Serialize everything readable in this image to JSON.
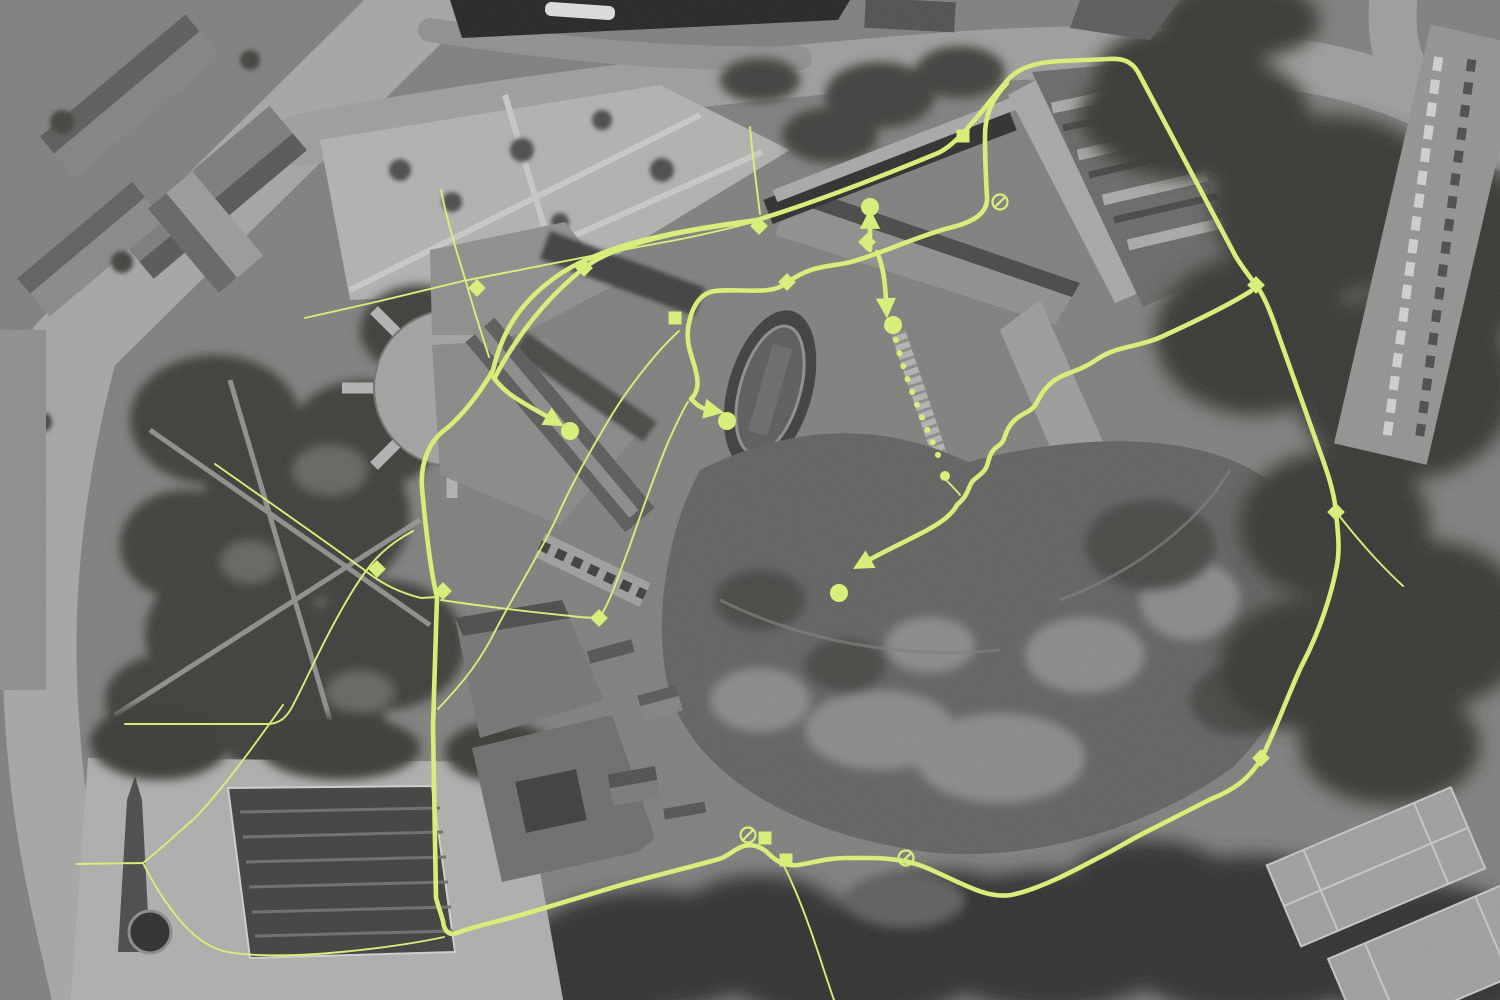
{
  "map": {
    "description": "Grayscale aerial photograph of a hilltop fortress and surrounding city with a lime route overlay",
    "canvas": {
      "width": 1500,
      "height": 1000
    },
    "palette": {
      "overlay_lime": "#d8ee7b",
      "base_gray": "#7e7e7c",
      "road_gray": "#a5a5a3",
      "tree_dark": "#343432",
      "plaza_light": "#aeaeac",
      "river_dark": "#222220"
    }
  },
  "overlay": {
    "color": "#d8ee7b",
    "thick_width": 4.6,
    "thin_width": 1.9,
    "dot_radius": 9,
    "small_dot_radius": 5,
    "diamond_size": 12.5,
    "square_size": 13,
    "no_entry_radius": 7.5,
    "dotted_dot_size": 6,
    "routes_thick": [
      {
        "name": "main-loop-route",
        "d": "M 493,370 C 502,332 520,300 563,272 C 610,243 680,230 757,220 C 812,203 880,177 938,153 C 960,143 984,107 1006,82 C 1015,70 1032,62 1062,61 L 1108,59 C 1124,58 1132,62 1138,72 L 1236,257 C 1243,268 1249,276 1256,285 C 1263,294 1270,310 1277,331 L 1319,449 C 1327,471 1334,491 1336,512 C 1338,533 1340,548 1337,565 C 1332,592 1321,629 1301,667 C 1288,695 1276,729 1262,757 C 1251,777 1236,789 1211,799 L 1152,829 C 1131,839 1113,851 1098,858 C 1079,868 1041,889 1011,895 C 986,899 962,883 927,868 C 911,861 891,858 869,858 L 846,858 C 826,858 813,863 798,865 C 786,866 778,863 769,854 C 761,846 751,843 741,847 C 732,851 727,857 719,859 C 691,867 661,874 621,885 L 521,915 C 496,922 471,927 457,933 C 449,936 444,931 443,921 L 436,898 L 433,727 L 437,597 C 434,585 428,554 422,488 C 420,462 430,440 446,429 C 464,414 482,390 493,370 Z"
      },
      {
        "name": "glacis-parallel-route",
        "d": "M 495,377 C 520,330 550,295 584,268 C 620,240 700,228 755,221"
      },
      {
        "name": "barracks-return-route",
        "d": "M 1007,83 C 994,97 985,112 985,136 C 985,161 986,180 987,197 C 988,213 974,222 949,228 C 918,236 880,254 851,262 C 830,267 810,265 787,283 C 770,296 741,288 715,291 C 700,293 691,307 688,329 C 686,348 694,359 697,377 C 699,389 695,395 691,399"
      },
      {
        "name": "serpentine-descent-route",
        "d": "M 1251,291 C 1229,305 1196,321 1161,337 C 1136,348 1118,345 1096,360 C 1076,374 1061,372 1048,386 C 1036,398 1039,406 1027,412 C 1015,418 1009,424 1005,436 C 1001,448 997,444 992,452 C 987,460 989,466 983,472 C 975,480 973,478 969,488 C 965,498 962,500 957,505"
      }
    ],
    "routes_thin": [
      {
        "name": "park-diagonal-path",
        "d": "M 305,318 L 380,301 L 463,281 C 530,268 610,252 660,243 C 700,236 731,228 754,222"
      },
      {
        "name": "plaza-north-path",
        "d": "M 441,190 C 448,225 458,256 466,282 C 472,304 481,332 489,357"
      },
      {
        "name": "north-gate-path",
        "d": "M 750,127 C 753,160 757,190 760,214"
      },
      {
        "name": "moat-diagonal-path",
        "d": "M 679,331 C 656,352 626,390 607,423 C 586,458 569,490 557,517 C 541,552 516,590 491,639 C 474,671 452,694 438,709"
      },
      {
        "name": "moat-lower-path",
        "d": "M 441,600 C 481,606 531,612 571,616 C 586,618 595,618 600,617 C 611,600 619,574 629,548 C 641,514 656,470 669,440 C 676,425 682,411 688,402"
      },
      {
        "name": "west-park-path",
        "d": "M 125,724 L 267,724 C 280,724 286,717 291,709 C 303,687 316,657 331,629 C 346,601 356,584 369,567 C 381,551 398,539 413,531"
      },
      {
        "name": "west-cross-path",
        "d": "M 215,464 C 266,500 321,538 363,569 C 383,585 401,593 421,598 L 437,597"
      },
      {
        "name": "southwest-link-path",
        "d": "M 77,864 L 143,863 C 161,849 176,834 194,819 C 223,789 253,747 283,705"
      },
      {
        "name": "plaza-south-path",
        "d": "M 143,863 C 152,881 166,905 184,925 C 197,939 211,949 228,952 C 256,957 301,956 341,952 C 372,949 412,944 444,937"
      },
      {
        "name": "south-exit-path",
        "d": "M 784,866 C 794,886 806,916 816,946 C 823,967 829,986 834,1000"
      },
      {
        "name": "east-exit-path",
        "d": "M 1337,513 C 1356,537 1376,561 1403,586"
      },
      {
        "name": "gate-link-path",
        "d": "M 947,481 C 952,486 957,491 960,495"
      }
    ],
    "arrows": [
      {
        "name": "arrow-to-north-gate-dot",
        "d": "M 870,250 L 870,227"
      },
      {
        "name": "arrow-to-courtyard-dot",
        "d": "M 877,252 C 883,266 885,281 886,300"
      },
      {
        "name": "arrow-to-terrace-dot",
        "d": "M 691,399 C 697,405 701,408 706,409"
      },
      {
        "name": "arrow-to-plaza-dot",
        "d": "M 492,375 C 504,394 522,402 548,417"
      },
      {
        "name": "arrow-to-hilltop-dot",
        "d": "M 957,505 C 946,526 908,538 869,560"
      }
    ],
    "dotted_path": {
      "name": "stairs-dotted-path",
      "d": "M 896,340 C 906,382 925,425 941,462",
      "dot_gap": 13.5
    },
    "dots": [
      {
        "name": "waypoint-dot-north-gate",
        "x": 870,
        "y": 207
      },
      {
        "name": "waypoint-dot-courtyard",
        "x": 893,
        "y": 325
      },
      {
        "name": "waypoint-dot-terrace",
        "x": 727,
        "y": 421
      },
      {
        "name": "waypoint-dot-west-plaza",
        "x": 570,
        "y": 431
      },
      {
        "name": "waypoint-dot-hilltop",
        "x": 839,
        "y": 593
      },
      {
        "name": "waypoint-dot-gate-small",
        "x": 945,
        "y": 476,
        "small": true
      }
    ],
    "diamonds": [
      {
        "name": "node-park-west",
        "x": 477,
        "y": 288
      },
      {
        "name": "node-glacis",
        "x": 584,
        "y": 268
      },
      {
        "name": "node-north-junction",
        "x": 759,
        "y": 226
      },
      {
        "name": "node-north-terrace",
        "x": 787,
        "y": 282
      },
      {
        "name": "node-north-gate",
        "x": 867,
        "y": 242
      },
      {
        "name": "node-west-junction",
        "x": 443,
        "y": 591
      },
      {
        "name": "node-moat-south",
        "x": 599,
        "y": 618
      },
      {
        "name": "node-southwest-cross",
        "x": 377,
        "y": 569
      },
      {
        "name": "node-northeast-corner",
        "x": 1256,
        "y": 285
      },
      {
        "name": "node-east-slope",
        "x": 1336,
        "y": 512
      },
      {
        "name": "node-southeast-slope",
        "x": 1261,
        "y": 758
      }
    ],
    "squares": [
      {
        "name": "stop-garden-terrace",
        "x": 675,
        "y": 318
      },
      {
        "name": "stop-barracks-west",
        "x": 963,
        "y": 136
      },
      {
        "name": "stop-south-gate-west",
        "x": 765,
        "y": 838
      },
      {
        "name": "stop-south-gate",
        "x": 786,
        "y": 860
      }
    ],
    "no_entry": [
      {
        "name": "no-entry-barracks",
        "x": 1000,
        "y": 202
      },
      {
        "name": "no-entry-south-west",
        "x": 748,
        "y": 835
      },
      {
        "name": "no-entry-south-east",
        "x": 906,
        "y": 858
      }
    ]
  }
}
